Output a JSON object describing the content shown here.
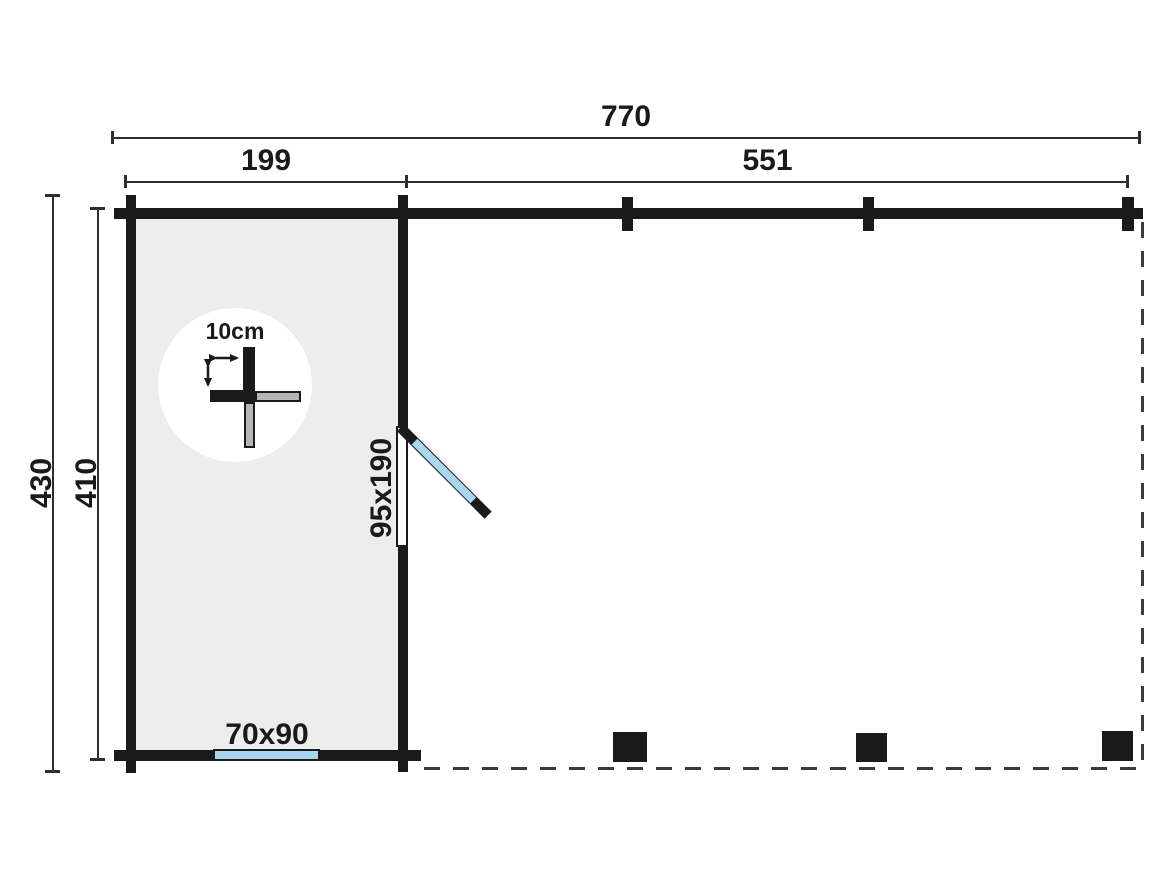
{
  "document": {
    "type": "floor-plan-drawing",
    "description": "Top-view dimension plan of a log cabin room with attached open canopy area"
  },
  "dimensions": {
    "overall_width": "770",
    "left_section_width": "199",
    "right_section_width": "551",
    "overall_depth": "430",
    "inner_depth": "410"
  },
  "annotations": {
    "wall_thickness_label": "10cm",
    "door_size_label": "95x190",
    "window_size_label": "70x90"
  },
  "features": {
    "posts_count": 3,
    "wall_post_marks_count": 3,
    "door_state": "open-45deg",
    "open_area_boundary": "dashed"
  },
  "colors": {
    "background": "#ffffff",
    "wall": "#1a1a1a",
    "room_fill": "#ededed",
    "glazing": "#a9d6ef",
    "log_fill": "#b5b5b5",
    "dim_line": "#2e2e2e",
    "dashed_line": "#3c3c3c",
    "text": "#1a1a1a"
  }
}
